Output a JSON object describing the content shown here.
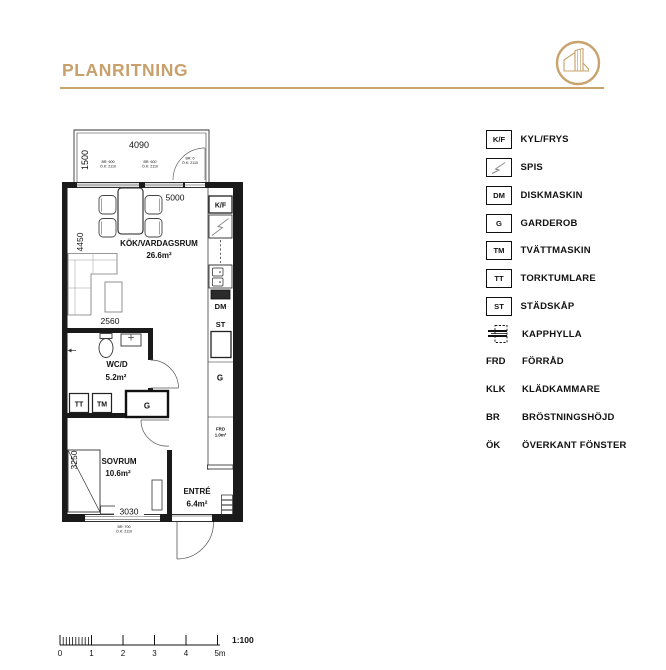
{
  "header": {
    "title": "PLANRITNING"
  },
  "colors": {
    "gold": "#C7A06B",
    "ink": "#111111"
  },
  "legend": {
    "items": [
      {
        "symbol": "K/F",
        "label": "KYL/FRYS"
      },
      {
        "symbol": "",
        "label": "SPIS"
      },
      {
        "symbol": "DM",
        "label": "DISKMASKIN"
      },
      {
        "symbol": "G",
        "label": "GARDEROB"
      },
      {
        "symbol": "TM",
        "label": "TVÄTTMASKIN"
      },
      {
        "symbol": "TT",
        "label": "TORKTUMLARE"
      },
      {
        "symbol": "ST",
        "label": "STÄDSKÅP"
      },
      {
        "symbol": "",
        "label": "KAPPHYLLA"
      },
      {
        "symbol": "FRD",
        "label": "FÖRRÅD"
      },
      {
        "symbol": "KLK",
        "label": "KLÄDKAMMARE"
      },
      {
        "symbol": "BR",
        "label": "BRÖSTNINGSHÖJD"
      },
      {
        "symbol": "ÖK",
        "label": "ÖVERKANT FÖNSTER"
      }
    ]
  },
  "plan": {
    "rooms": {
      "kitchen_living": {
        "name": "KÖK/VARDAGSRUM",
        "area": "26.6m²"
      },
      "wc": {
        "name": "WC/D",
        "area": "5.2m²"
      },
      "bedroom": {
        "name": "SOVRUM",
        "area": "10.6m²"
      },
      "entry": {
        "name": "ENTRÉ",
        "area": "6.4m²"
      }
    },
    "fixtures": {
      "fridge": "K/F",
      "dishwasher": "DM",
      "cleaning_cab": "ST",
      "washer": "TM",
      "dryer": "TT",
      "wardrobe_hall": "G",
      "wardrobe_bedroom": "G",
      "storage": "FRD",
      "storage_area": "1.0m²"
    },
    "dims": {
      "balcony_width": "4090",
      "balcony_depth": "1500",
      "kitchen_width": "5000",
      "kitchen_depth": "4450",
      "wc_width": "2560",
      "bedroom_depth": "3250",
      "bedroom_width": "3030"
    },
    "notes": {
      "n1": {
        "br": "BR: 600",
        "ok": "Ö.K: 2110"
      },
      "n2": {
        "br": "BR: 600",
        "ok": "Ö.K: 2110"
      },
      "n3": {
        "br": "BR: 0",
        "ok": "Ö.K: 2110"
      },
      "n4": {
        "br": "BR: 700",
        "ok": "Ö.K: 2110"
      }
    }
  },
  "scalebar": {
    "labels": [
      "0",
      "1",
      "2",
      "3",
      "4",
      "5m"
    ],
    "ratio": "1:100"
  }
}
